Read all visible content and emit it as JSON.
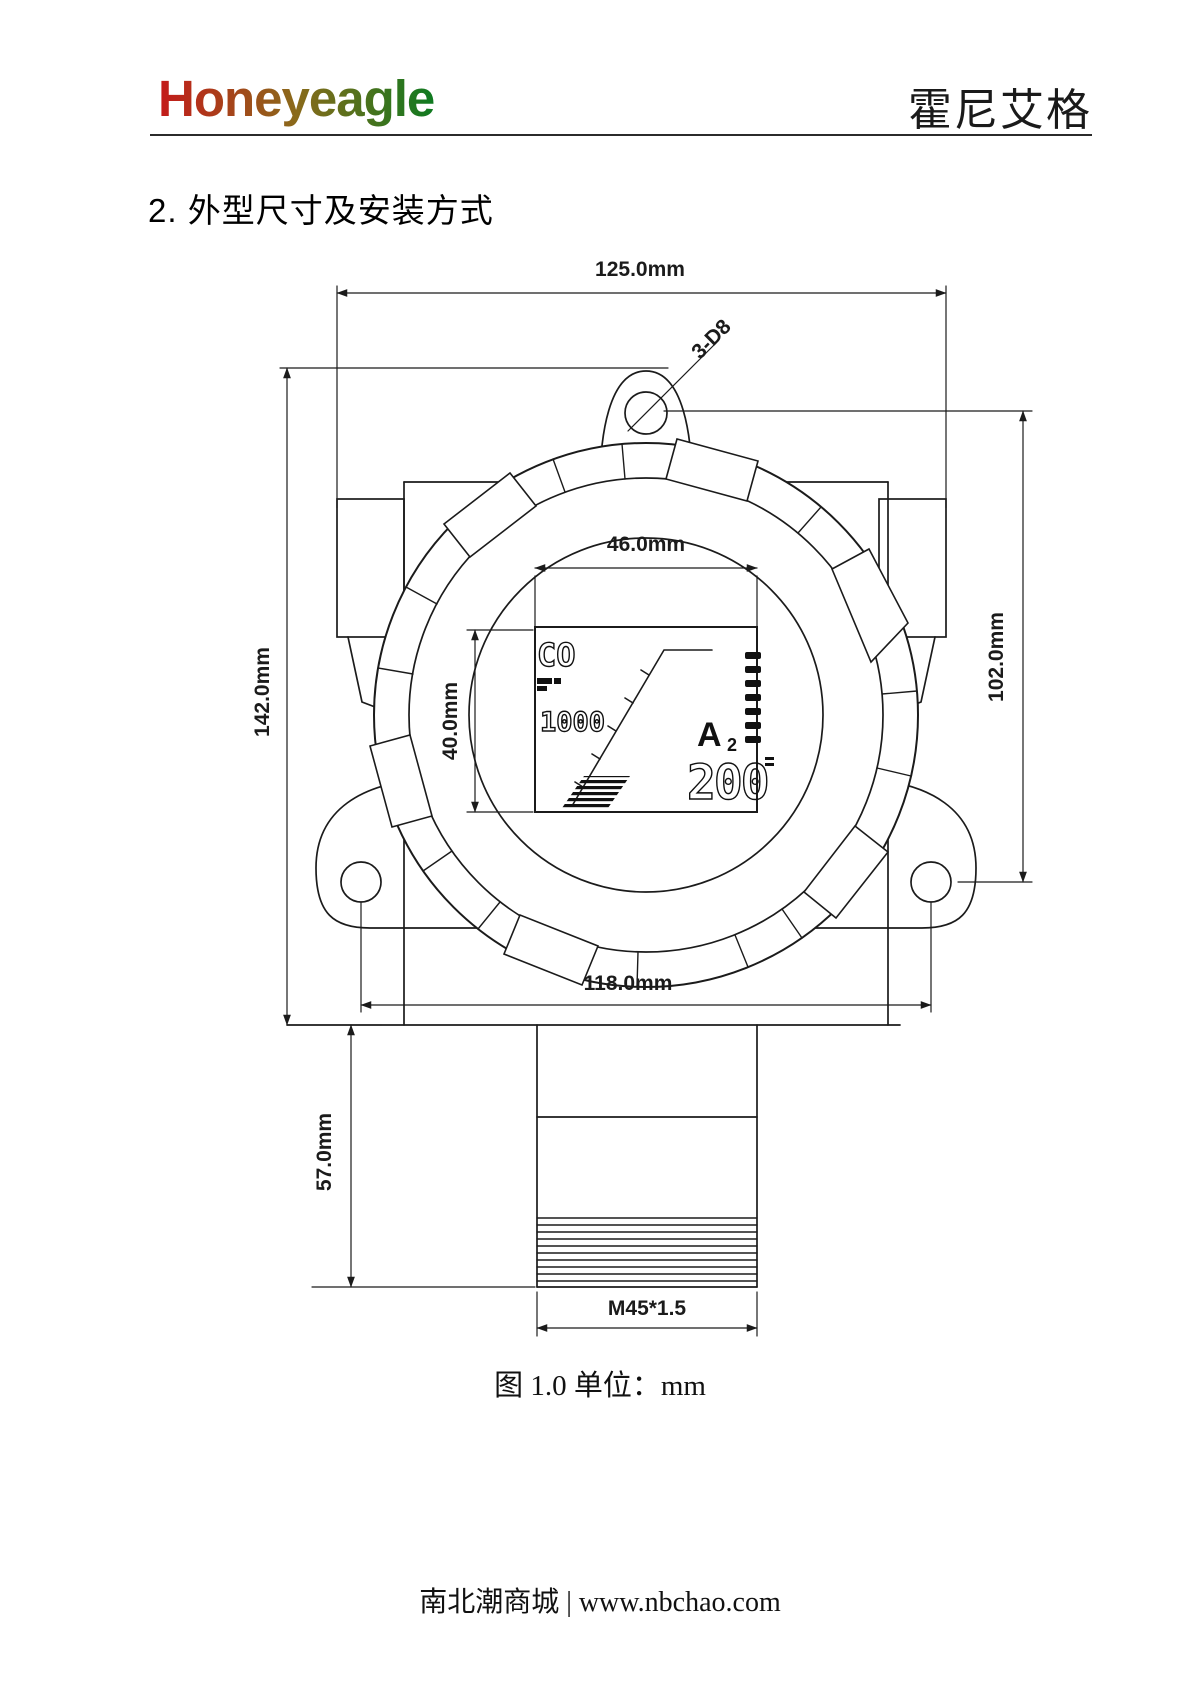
{
  "header": {
    "brand": "Honeyeagle",
    "brand_cn": "霍尼艾格",
    "brand_colors": [
      "#c41a1a",
      "#8a6a1a",
      "#0e7a20"
    ]
  },
  "section_title": "2. 外型尺寸及安装方式",
  "drawing": {
    "dims": {
      "top_width": "125.0mm",
      "overall_height": "142.0mm",
      "right_height": "102.0mm",
      "display_width": "46.0mm",
      "display_height": "40.0mm",
      "hole_spacing": "118.0mm",
      "probe_height": "57.0mm",
      "thread_spec": "M45*1.5",
      "mount_hole": "3-D8"
    },
    "lcd": {
      "gas": "CO",
      "value_small": "1000",
      "alarm": "A",
      "alarm_sub": "2",
      "value_large": "200"
    }
  },
  "caption": "图 1.0 单位：mm",
  "footer": "南北潮商城 | www.nbchao.com"
}
